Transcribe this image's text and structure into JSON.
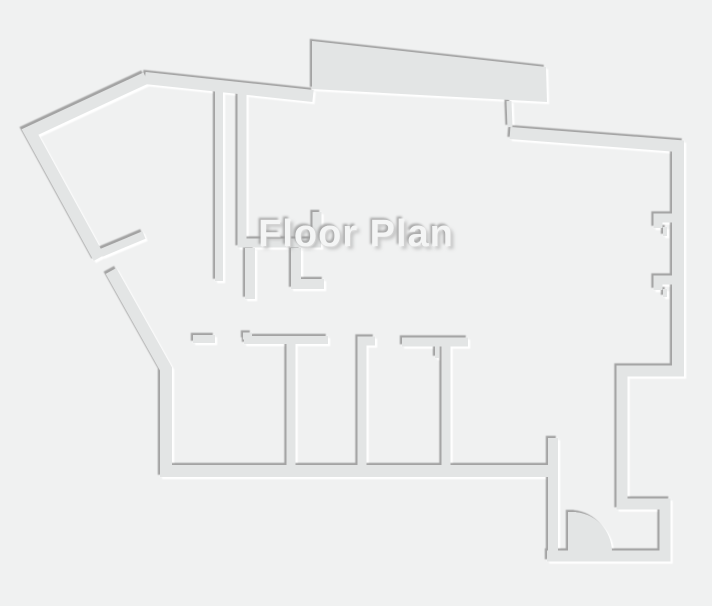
{
  "title": {
    "label": "Floor Plan"
  },
  "colors": {
    "background": "#f0f1f1",
    "wall": "#e3e5e5",
    "emboss_dark": "#9e9e9e",
    "emboss_light": "#ffffff",
    "title_text": "#f4f5f5"
  },
  "floor_plan": {
    "canvas": {
      "width": 712,
      "height": 606
    },
    "walls": [
      {
        "name": "outer-wall-top-left-diagonal",
        "d": "M146,78 L30,132 L99,258",
        "w": 12
      },
      {
        "name": "outer-wall-lower-diagonal-left-bottom",
        "d": "M111,271 L166,369 L166,471 L553,471",
        "w": 12
      },
      {
        "name": "outer-wall-top",
        "d": "M145,78 L313,96",
        "w": 12
      },
      {
        "name": "band-connector-wall",
        "d": "M509,101 L510,127",
        "w": 5
      },
      {
        "name": "outer-wall-top-right-and-right",
        "d": "M510,133 L678,146 L678,371",
        "w": 12
      },
      {
        "name": "alcove-walls-right-bottom",
        "d": "M684,371 L622,371 L622,504 L665,504 L665,556 L547,556",
        "w": 11
      },
      {
        "name": "entry-side-wall",
        "d": "M553,438 L553,551",
        "w": 10
      },
      {
        "name": "diagonal-door-jamb",
        "d": "M101,253 L144,235",
        "w": 8
      },
      {
        "name": "corridor-wall",
        "d": "M219,90 L219,281",
        "w": 8
      },
      {
        "name": "closet-walls",
        "d": "M242,93 L242,243 L321,243",
        "w": 9
      },
      {
        "name": "closet-right-stub",
        "d": "M317,212 L317,240",
        "w": 9
      },
      {
        "name": "closet-door-jamb-left",
        "d": "M250,248 L250,299",
        "w": 10
      },
      {
        "name": "closet-door-jamb-right",
        "d": "M296,248 L296,284 L324,284",
        "w": 10
      },
      {
        "name": "room1-top-stub",
        "d": "M193,339 L215,339",
        "w": 8
      },
      {
        "name": "room1-top-step",
        "d": "M243,336 L252,336",
        "w": 7
      },
      {
        "name": "room1-top-wall",
        "d": "M244,340 L328,340",
        "w": 8
      },
      {
        "name": "room-divider-1",
        "d": "M291,344 L291,466",
        "w": 9
      },
      {
        "name": "room-divider-2",
        "d": "M375,341 L362,341 L362,466",
        "w": 9
      },
      {
        "name": "room3-top-wall",
        "d": "M402,342 L468,342",
        "w": 9
      },
      {
        "name": "room3-jamb-tick",
        "d": "M437,346 L437,358",
        "w": 4
      },
      {
        "name": "room-divider-3",
        "d": "M446,342 L446,466",
        "w": 9
      },
      {
        "name": "right-wall-notch-1",
        "d": "M678,218 L658,218 L658,228",
        "w": 9
      },
      {
        "name": "right-wall-notch-1-tick",
        "d": "M665,227 L665,236",
        "w": 4
      },
      {
        "name": "right-wall-notch-2",
        "d": "M678,280 L658,280 L658,290",
        "w": 9
      },
      {
        "name": "right-wall-notch-2-tick",
        "d": "M665,289 L665,297",
        "w": 4
      },
      {
        "name": "door-leaf",
        "d": "M572,512 L572,552",
        "w": 8
      }
    ],
    "polygons": [
      {
        "name": "top-protrusion-band",
        "points": "312,41 546,67 547,102 312,89"
      }
    ],
    "door_swing": {
      "name": "door-swing-arc",
      "d": "M572,552 L572,512 A40,40 0 0 1 612,552 Z"
    }
  }
}
